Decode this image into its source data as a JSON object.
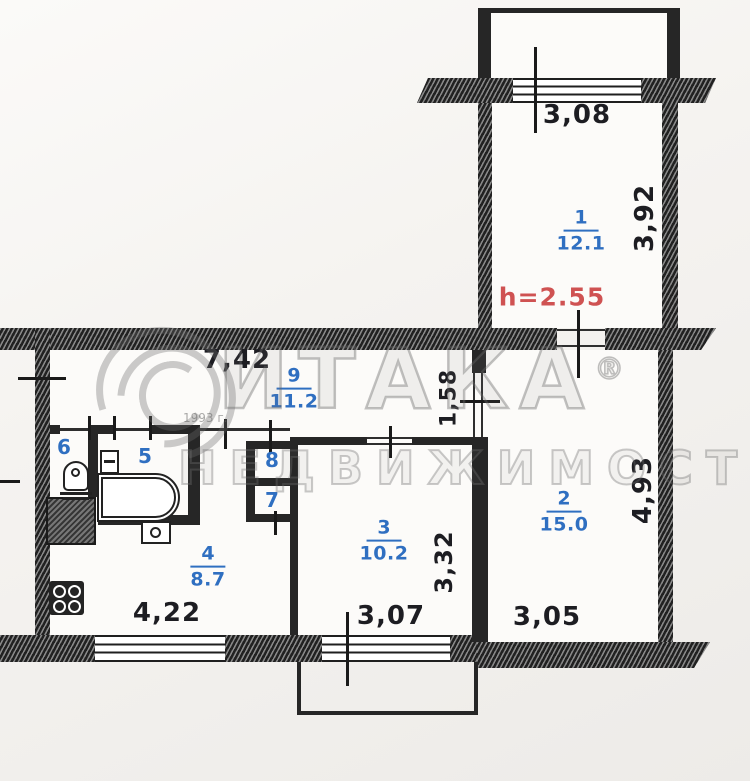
{
  "plan": {
    "height_note": "h=2.55",
    "watermark": {
      "brand": "ИТАКА",
      "reg": "®",
      "line2": "НЕДВИЖИМОСТЬ",
      "year": "1993 г."
    },
    "dims": {
      "top_window": "3,08",
      "room1_depth": "3,92",
      "hall_width": "7,42",
      "hall_depth": "1,58",
      "room2_depth": "4,93",
      "room2_width": "3,05",
      "room3_width": "3,07",
      "room3_depth": "3,32",
      "kitchen_width": "4,22"
    },
    "rooms": {
      "r1": {
        "num": "1",
        "area": "12.1"
      },
      "r2": {
        "num": "2",
        "area": "15.0"
      },
      "r3": {
        "num": "3",
        "area": "10.2"
      },
      "r4": {
        "num": "4",
        "area": "8.7"
      },
      "r9": {
        "num": "9",
        "area": "11.2"
      },
      "r5": {
        "num": "5"
      },
      "r6": {
        "num": "6"
      },
      "r7": {
        "num": "7"
      },
      "r8": {
        "num": "8"
      }
    },
    "colors": {
      "label_blue": "#2f6fc1",
      "height_red": "#cf5252",
      "wall_dark": "#262626"
    }
  }
}
